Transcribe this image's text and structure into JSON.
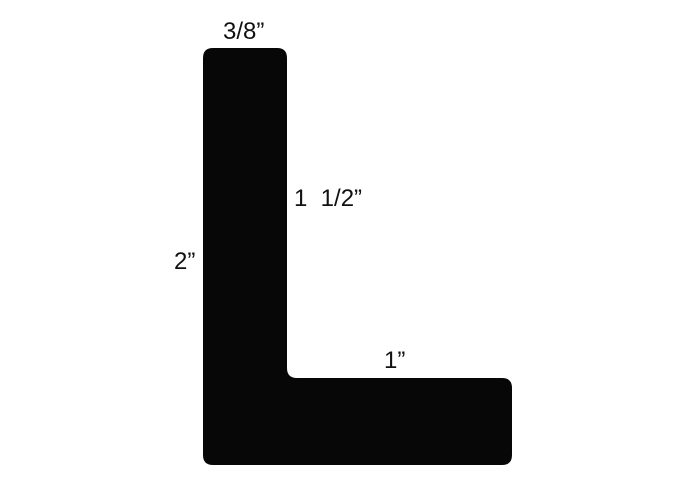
{
  "figure": {
    "background_color": "#ffffff",
    "shape_color": "#070707",
    "text_color": "#111111",
    "labels": {
      "top_width": "3/8”",
      "inner_height": "1  1/2”",
      "left_height": "2”",
      "arm_length": "1”"
    }
  }
}
